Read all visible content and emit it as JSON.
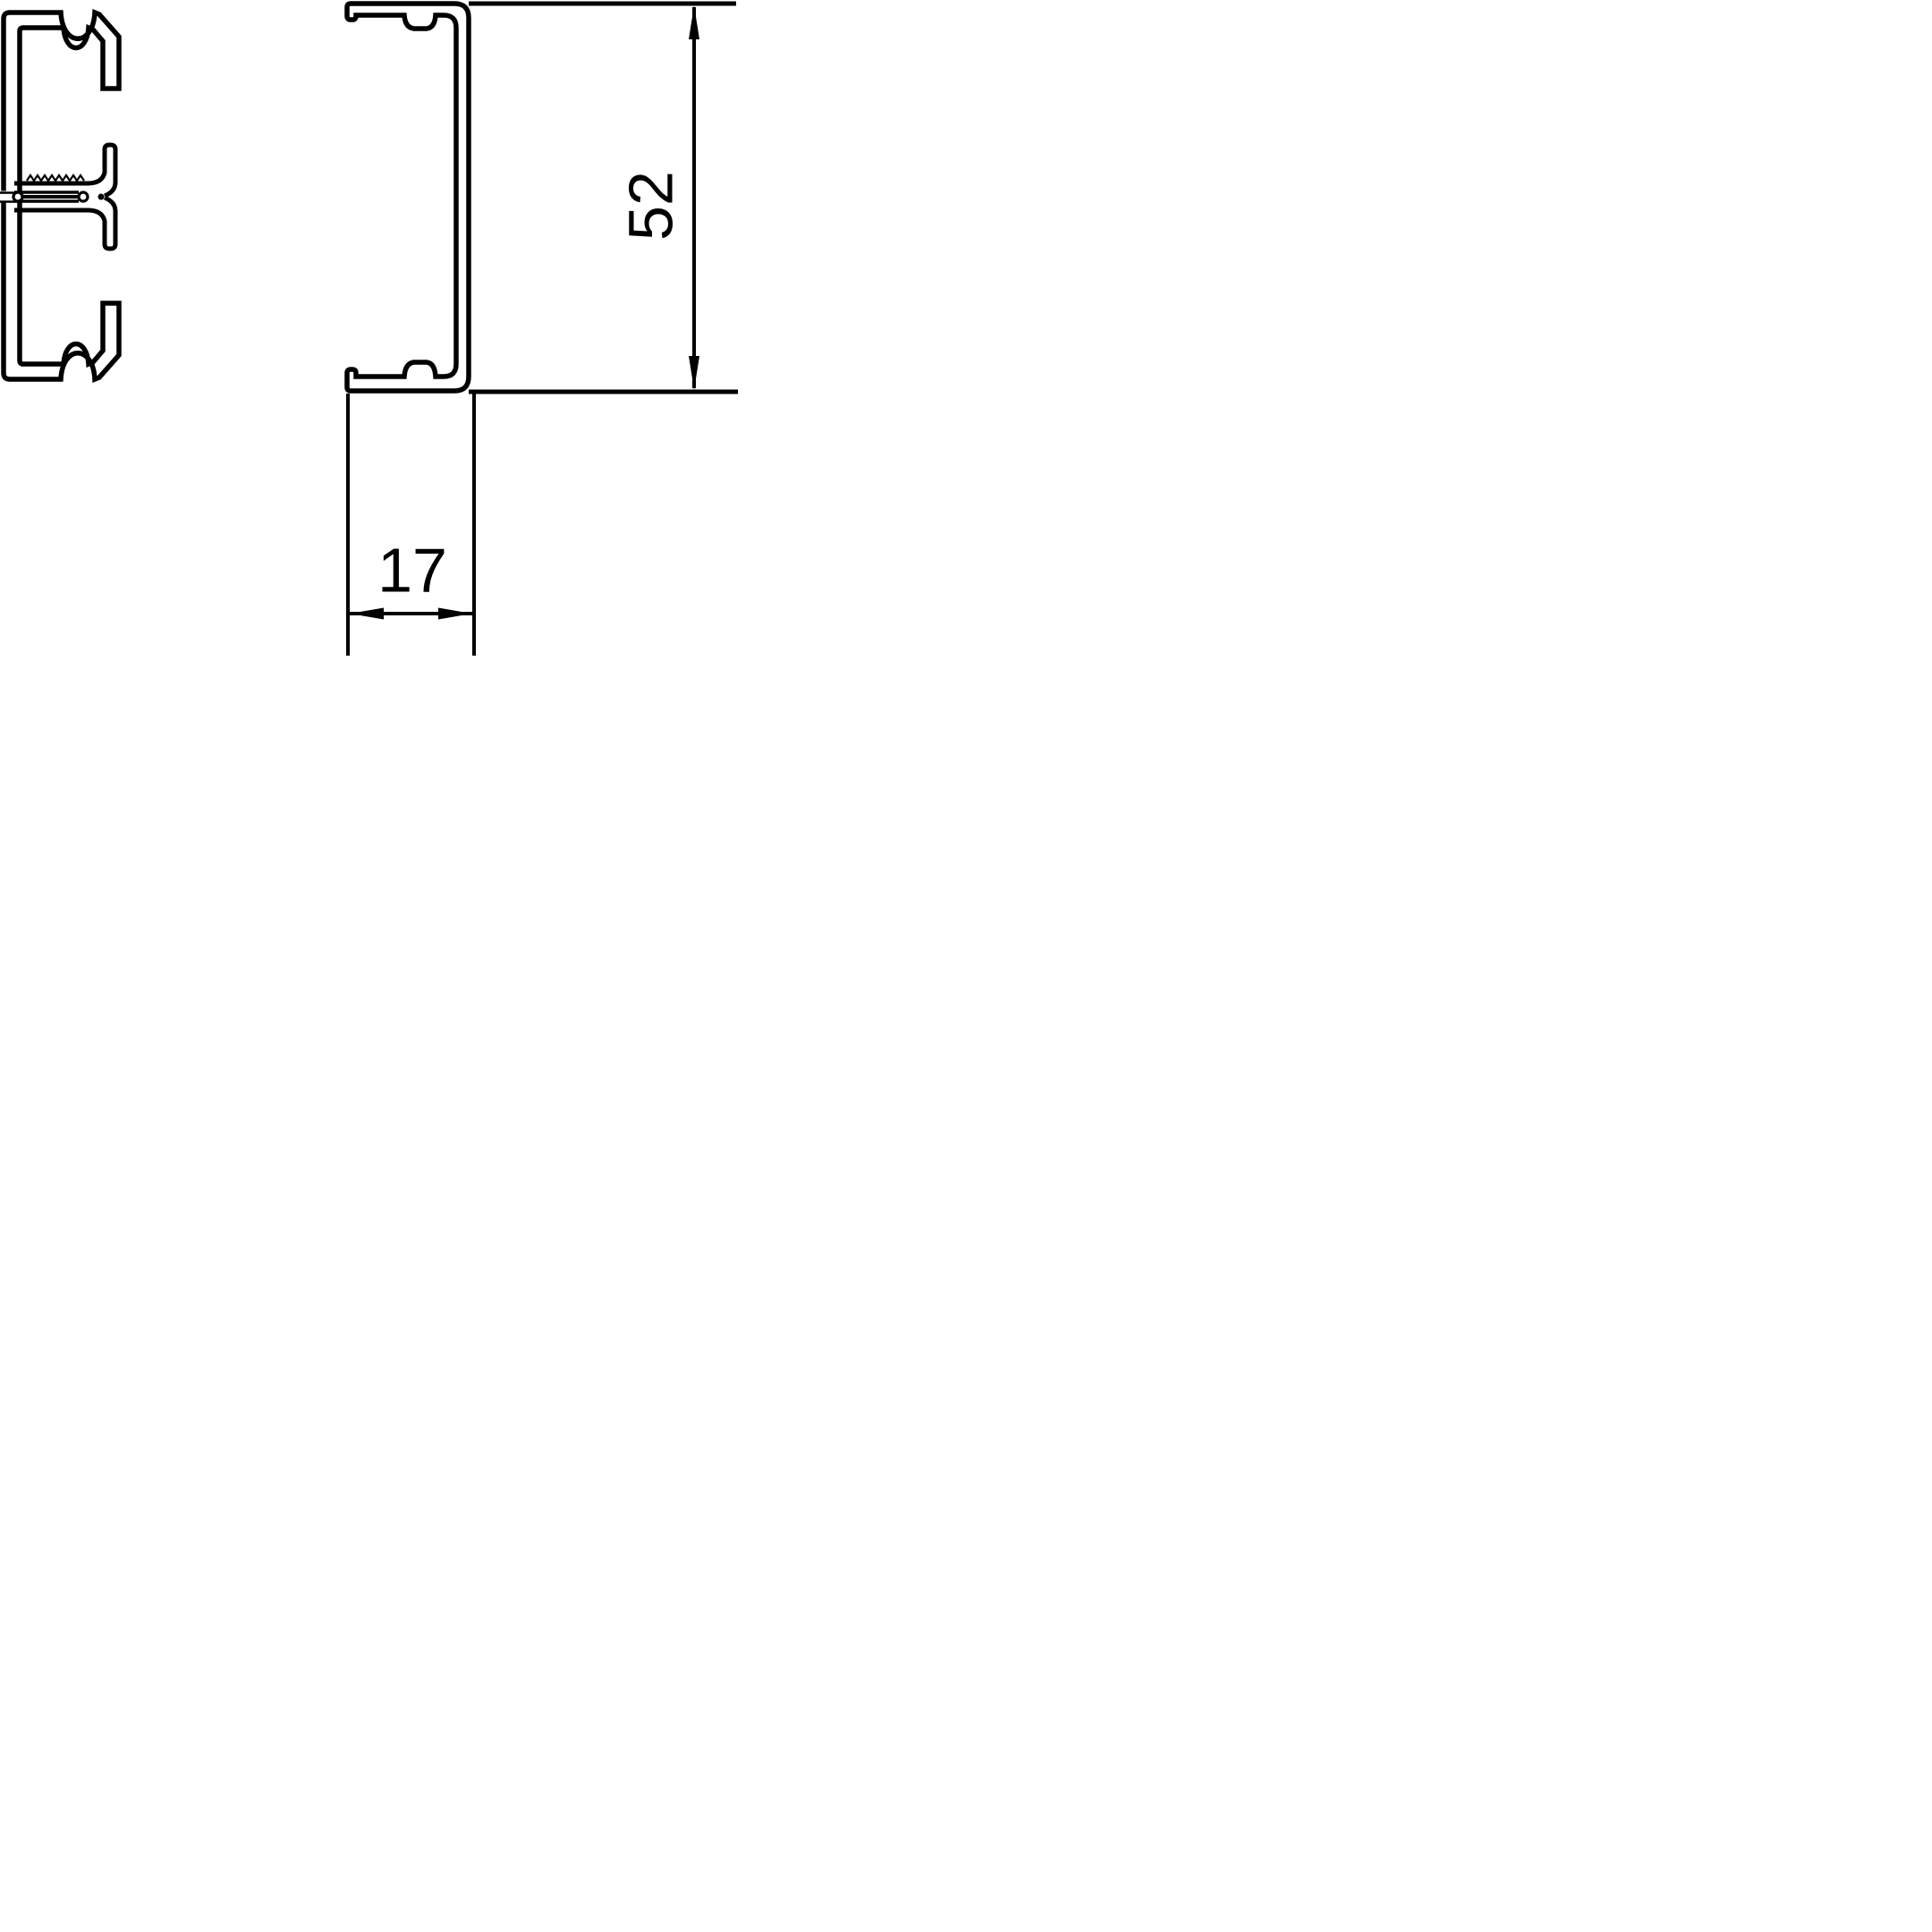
{
  "drawing": {
    "background_color": "#ffffff",
    "line_color": "#000000",
    "dimensions": {
      "height": {
        "value": "52",
        "orientation": "vertical"
      },
      "width": {
        "value": "17",
        "orientation": "horizontal"
      }
    }
  }
}
